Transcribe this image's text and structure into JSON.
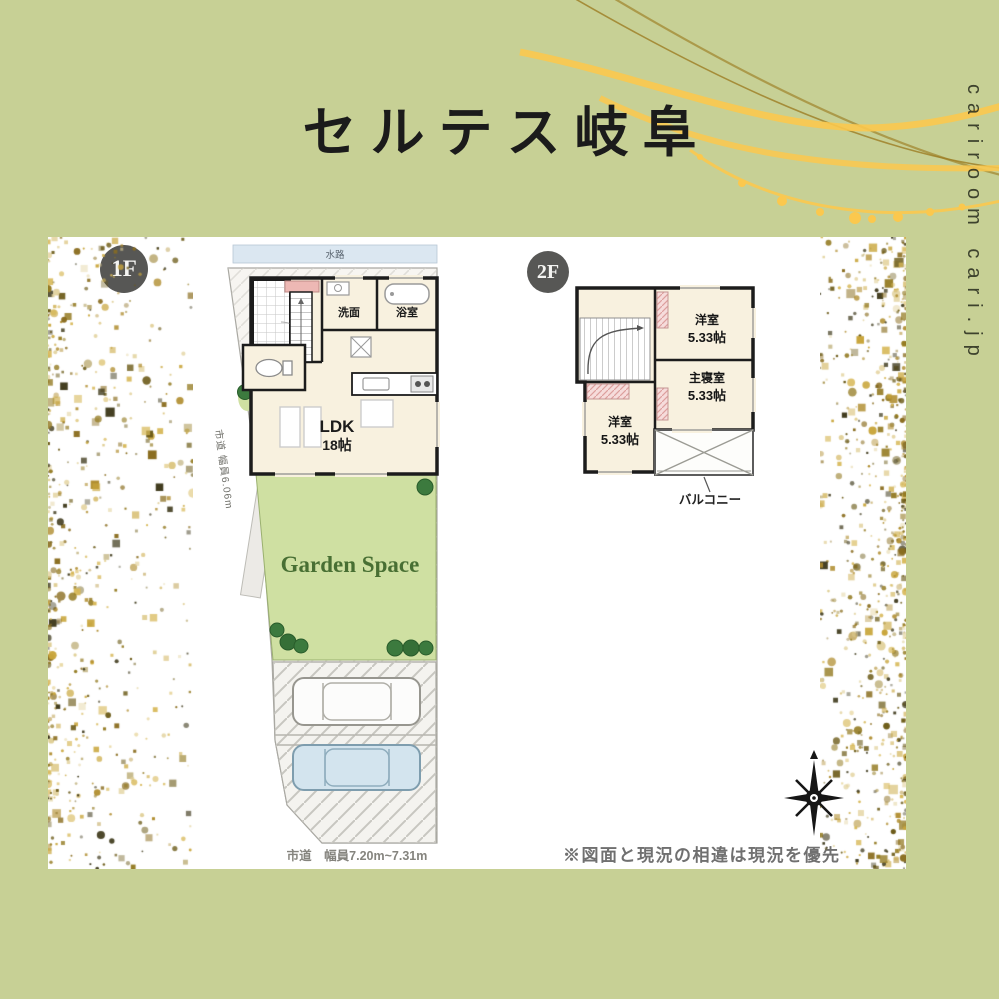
{
  "page": {
    "background": "#c7d095",
    "card_bg": "#ffffff",
    "accent": {
      "gold_thick": "#fbc84e",
      "gold_thin": "#9c7c22",
      "confetti": [
        "#b08d2f",
        "#8a6d1f",
        "#d7b858",
        "#3f3a1c",
        "#c9a63c",
        "#e0cf96",
        "#6b5a17",
        "#947b23"
      ]
    }
  },
  "header": {
    "title": "セルテス岐阜"
  },
  "watermark": {
    "text": "cariroom cari.jp"
  },
  "plan1f": {
    "badge": "1F",
    "water_strip": "水路",
    "rooms": {
      "washroom": "洗面",
      "bathroom": "浴室",
      "ldk_name": "LDK",
      "ldk_size": "18帖"
    },
    "garden": "Garden Space",
    "road_left": "市道 幅員6.06m",
    "road_bottom": "市道　幅員7.20m~7.31m"
  },
  "plan2f": {
    "badge": "2F",
    "rooms": [
      {
        "name": "洋室",
        "size": "5.33帖"
      },
      {
        "name": "主寝室",
        "size": "5.33帖"
      },
      {
        "name": "洋室",
        "size": "5.33帖"
      }
    ],
    "balcony": "バルコニー"
  },
  "footer": {
    "note": "※図面と現況の相違は現況を優先"
  }
}
